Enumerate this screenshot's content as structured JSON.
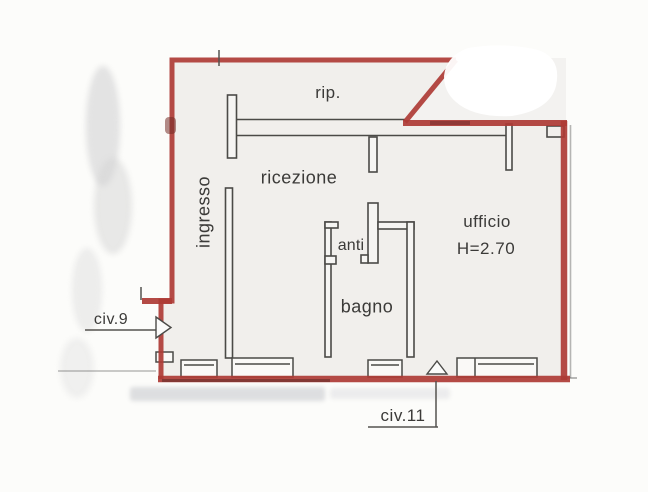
{
  "document": {
    "type": "scanned-floorplan",
    "rooms": {
      "rip": "rip.",
      "ricezione": "ricezione",
      "ingresso": "ingresso",
      "anti": "anti",
      "bagno": "bagno",
      "ufficio": "ufficio",
      "ufficio_ceiling_height": "H=2.70"
    },
    "annotations": {
      "civ9": "civ.9",
      "civ11": "civ.11"
    },
    "icons": {
      "civ9_arrow": "entrance-arrow-right-icon",
      "civ11_arrow": "entrance-arrow-up-icon"
    },
    "colors": {
      "wall_red": "#ae3b35",
      "line_dark": "#4b4a47",
      "interior_fill": "#f1efec",
      "paper": "#fcfcfa",
      "text": "#3b3a38"
    }
  }
}
